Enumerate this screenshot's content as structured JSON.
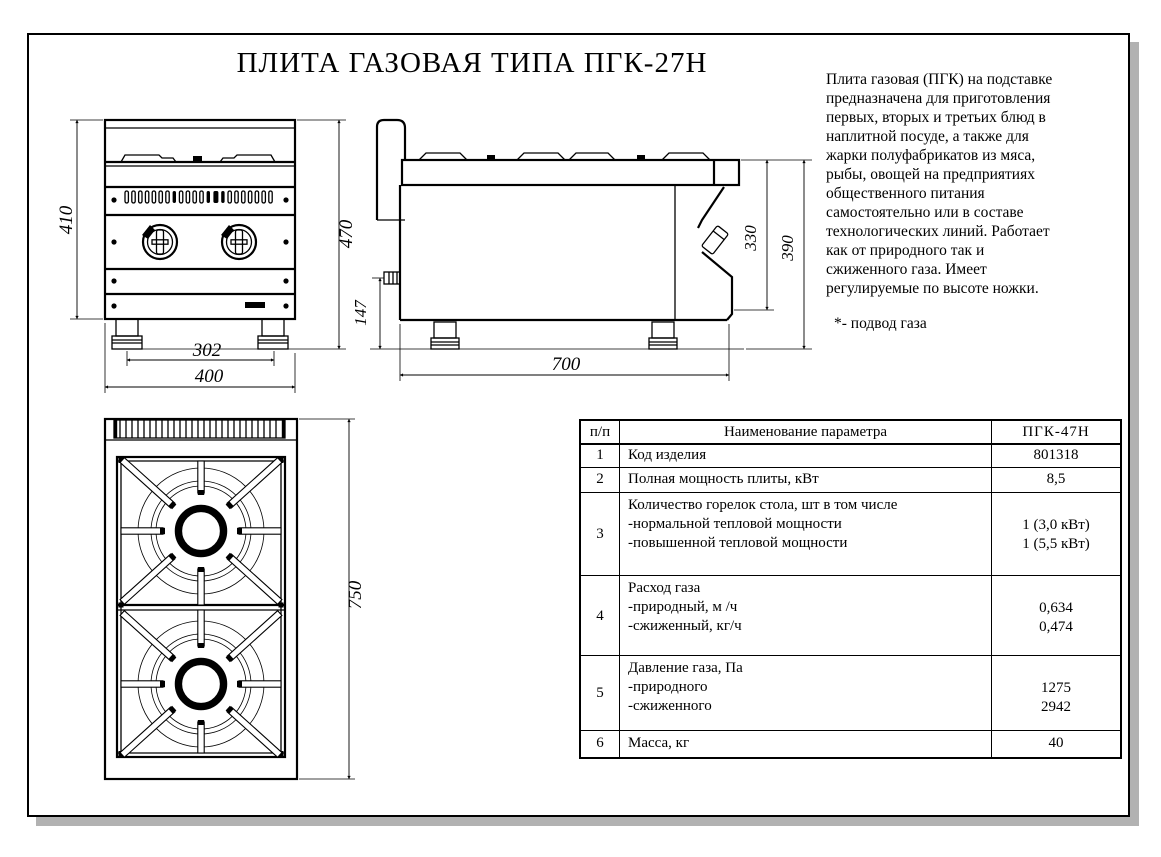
{
  "page": {
    "title": "ПЛИТА ГАЗОВАЯ ТИПА ПГК-27Н"
  },
  "description": {
    "lines": [
      "Плита газовая (ПГК) на подставке",
      "предназначена для приготовления",
      "первых, вторых и третьих блюд в",
      "наплитной посуде, а также для",
      " жарки полуфабрикатов из мяса,",
      "рыбы, овощей на предприятиях",
      "общественного питания",
      "самостоятельно или в составе",
      "технологических линий. Работает",
      "как от природного так и",
      "сжиженного газа. Имеет",
      "регулируемые по высоте ножки."
    ],
    "note": "*- подвод газа"
  },
  "dims": {
    "front_height_body": "410",
    "front_height_total": "470",
    "front_width_feet": "302",
    "front_width_total": "400",
    "side_gas_inlet_height": "147",
    "side_panel_height": "330",
    "side_height_total": "390",
    "side_depth": "700",
    "top_depth": "750"
  },
  "table": {
    "headers": {
      "num": "п/п",
      "name": "Наименование параметра",
      "model": "ПГК-47Н"
    },
    "rows": [
      {
        "num": "1",
        "name_lines": [
          "Код изделия"
        ],
        "value_lines": [
          "801318"
        ]
      },
      {
        "num": "2",
        "name_lines": [
          "Полная мощность плиты, кВт"
        ],
        "value_lines": [
          "8,5"
        ]
      },
      {
        "num": "3",
        "name_lines": [
          "Количество горелок стола, шт в том числе",
          "-нормальной тепловой мощности",
          "-повышенной тепловой мощности"
        ],
        "value_lines": [
          "1 (3,0 кВт)",
          "1 (5,5 кВт)"
        ]
      },
      {
        "num": "4",
        "name_lines": [
          "Расход газа",
          "-природный, м /ч",
          "-сжиженный, кг/ч"
        ],
        "value_lines": [
          "0,634",
          "0,474"
        ]
      },
      {
        "num": "5",
        "name_lines": [
          "Давление  газа, Па",
          "-природного",
          "-сжиженного"
        ],
        "value_lines": [
          "1275",
          "2942"
        ]
      },
      {
        "num": "6",
        "name_lines": [
          "Масса, кг"
        ],
        "value_lines": [
          "40"
        ]
      }
    ]
  }
}
